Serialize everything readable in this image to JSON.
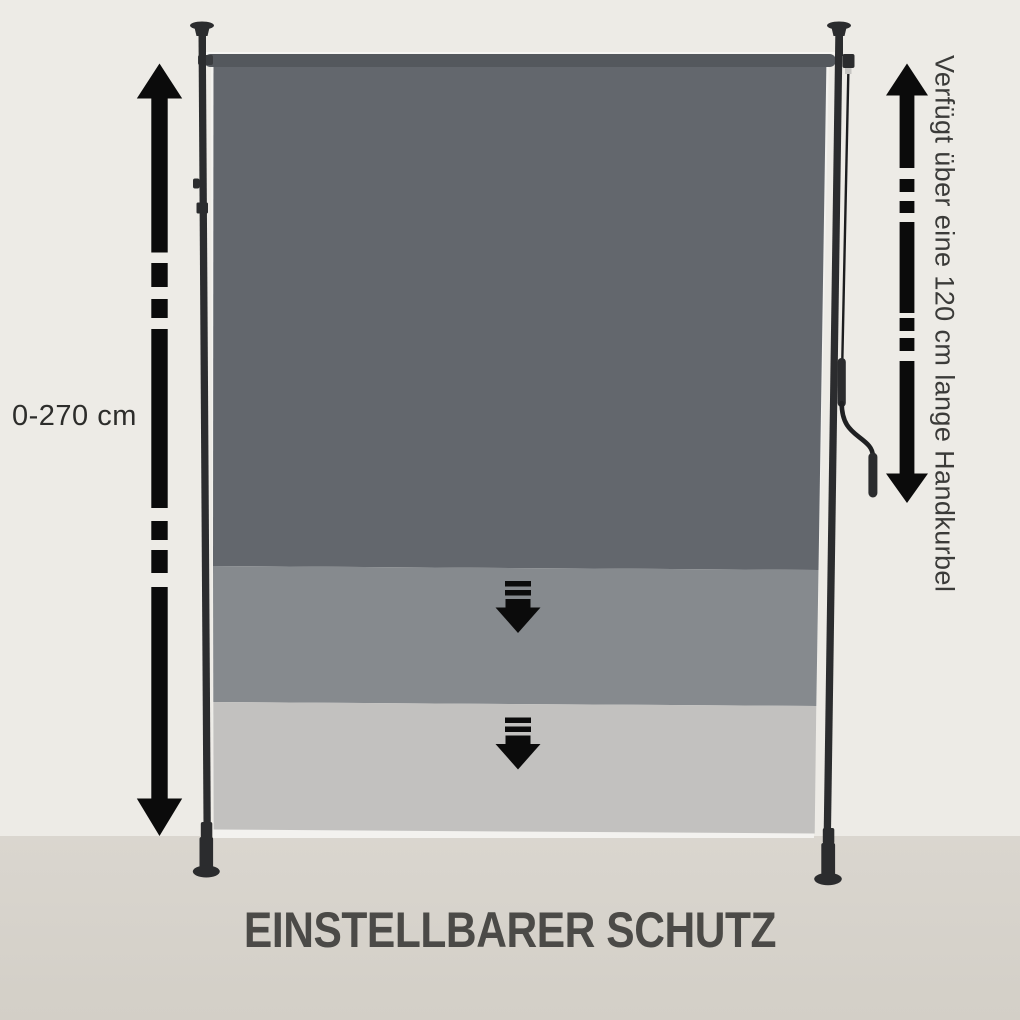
{
  "illustration": {
    "title": "EINSTELLBARER SCHUTZ",
    "annotations": {
      "height_range": "0-270 cm",
      "crank_note": "Verfügt über eine 120 cm lange Handkurbel"
    }
  },
  "colors": {
    "background": "#edebe6",
    "floor": "#dad6cf",
    "fabric_dark": "#63676d",
    "fabric_medium": "#868a8e",
    "fabric_light": "#c2c1bf",
    "fabric_edge": "#f3f2ef",
    "roller": "#54585d",
    "pole": "#2b2c2e",
    "arrow": "#0b0b0b",
    "title_text": "#4b4a47",
    "label_text": "#2d2d2b",
    "note_text": "#3b3b39"
  }
}
